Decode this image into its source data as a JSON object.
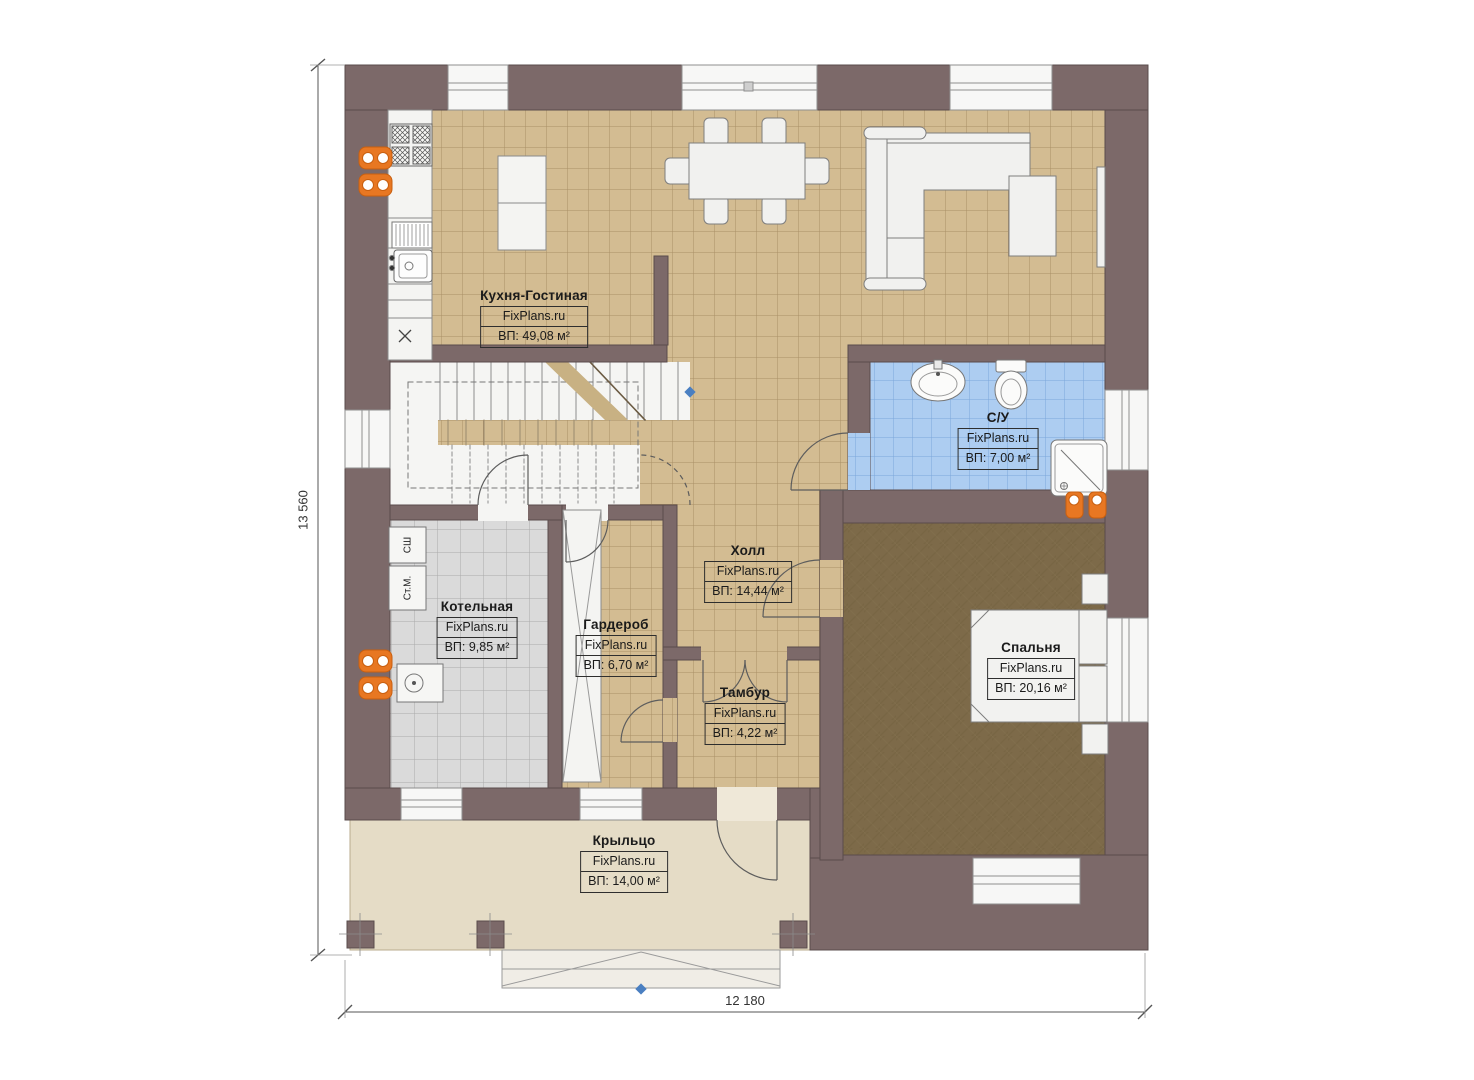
{
  "plan": {
    "brand": "FixPlans.ru",
    "rooms": [
      {
        "id": "kitchen-living",
        "name": "Кухня-Гостиная",
        "watermark": "FixPlans.ru",
        "area": "ВП: 49,08 м²"
      },
      {
        "id": "bathroom",
        "name": "С/У",
        "watermark": "FixPlans.ru",
        "area": "ВП: 7,00 м²"
      },
      {
        "id": "hall",
        "name": "Холл",
        "watermark": "FixPlans.ru",
        "area": "ВП: 14,44 м²"
      },
      {
        "id": "boiler-room",
        "name": "Котельная",
        "watermark": "FixPlans.ru",
        "area": "ВП: 9,85 м²"
      },
      {
        "id": "wardrobe",
        "name": "Гардероб",
        "watermark": "FixPlans.ru",
        "area": "ВП: 6,70 м²"
      },
      {
        "id": "vestibule",
        "name": "Тамбур",
        "watermark": "FixPlans.ru",
        "area": "ВП: 4,22 м²"
      },
      {
        "id": "bedroom",
        "name": "Спальня",
        "watermark": "FixPlans.ru",
        "area": "ВП: 20,16 м²"
      },
      {
        "id": "porch",
        "name": "Крыльцо",
        "watermark": "FixPlans.ru",
        "area": "ВП: 14,00 м²"
      }
    ],
    "equipment": [
      {
        "label": "СШ"
      },
      {
        "label": "Ст.М."
      }
    ],
    "dimensions": {
      "left": "13 560",
      "bottom": "12 180"
    },
    "colors": {
      "wall": "#7c6969",
      "tile_beige": "#d3bc92",
      "tile_blue": "#adcdf1",
      "tile_gray": "#d9d9d9",
      "carpet_brown": "#7d6a49",
      "porch_floor": "#e5dcc6",
      "accent_orange": "#e87722",
      "marker_blue": "#4a7fc1"
    }
  }
}
